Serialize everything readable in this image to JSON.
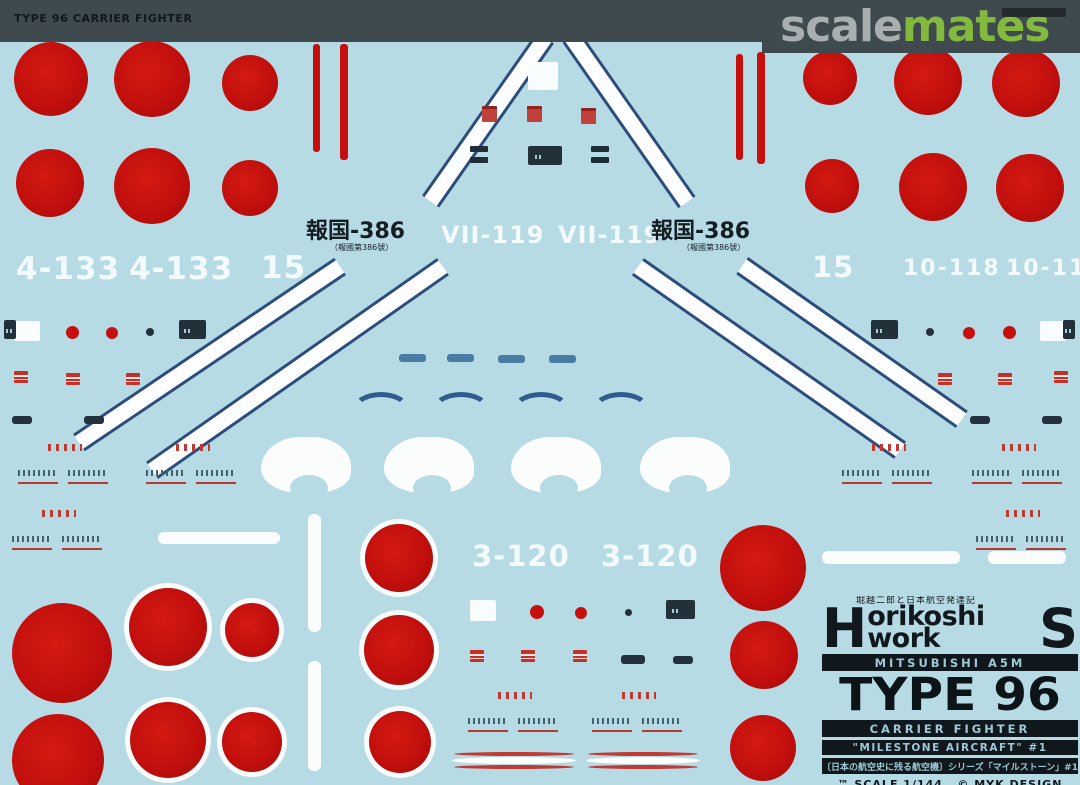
{
  "header": {
    "sheet_title": "TYPE 96 CARRIER FIGHTER",
    "logo_scale": "scale",
    "logo_mates": "mates"
  },
  "sheet": {
    "codes": {
      "tl_1": "4-133",
      "tl_2": "4-133",
      "tl_3": "15",
      "tc_1": "VII-119",
      "tc_2": "VII-119",
      "tr_1": "15",
      "tr_2": "10-118",
      "tr_3": "10-118",
      "bc_1": "3-120",
      "bc_2": "3-120",
      "hokoku_left": "報国-386",
      "hokoku_left_sub": "（報國第386號）",
      "hokoku_right": "報国-386",
      "hokoku_right_sub": "（報國第386號）"
    },
    "info_box": {
      "kanji_tagline": "堀越二郎と日本航空発達記",
      "brand_h": "H",
      "brand_mid": "orikoshi work",
      "brand_s": "S",
      "line1": "MITSUBISHI A5M",
      "line2": "TYPE 96",
      "line3": "CARRIER FIGHTER",
      "line4": "\"MILESTONE AIRCRAFT\" #1",
      "line5": "〔日本の航空史に残る航空機〕シリーズ「マイルストーン」#1",
      "line6": "™ SCALE 1/144   © MYK DESIGN"
    }
  },
  "colors": {
    "sheet_blue": "#b7dbe5",
    "hinomaru_red": "#c5100f",
    "stripe_navy": "#2c4d7c",
    "header_bar": "#3e4a4e",
    "logo_gray": "#a9aeb1",
    "logo_green": "#83b93d",
    "ink_black": "#10181d",
    "knockout_text": "#9fc8d4"
  },
  "decal_shapes": {
    "roundels": [
      {
        "cx": 51,
        "cy": 79,
        "r": 37
      },
      {
        "cx": 152,
        "cy": 79,
        "r": 38
      },
      {
        "cx": 250,
        "cy": 83,
        "r": 28
      },
      {
        "cx": 50,
        "cy": 183,
        "r": 34
      },
      {
        "cx": 152,
        "cy": 186,
        "r": 38
      },
      {
        "cx": 250,
        "cy": 188,
        "r": 28
      },
      {
        "cx": 830,
        "cy": 78,
        "r": 27
      },
      {
        "cx": 928,
        "cy": 81,
        "r": 34
      },
      {
        "cx": 1026,
        "cy": 83,
        "r": 34
      },
      {
        "cx": 832,
        "cy": 186,
        "r": 27
      },
      {
        "cx": 933,
        "cy": 187,
        "r": 34
      },
      {
        "cx": 1030,
        "cy": 188,
        "r": 34
      },
      {
        "cx": 62,
        "cy": 653,
        "r": 50
      },
      {
        "cx": 58,
        "cy": 760,
        "r": 46
      },
      {
        "cx": 168,
        "cy": 627,
        "r": 39,
        "ring": 1
      },
      {
        "cx": 252,
        "cy": 630,
        "r": 27,
        "ring": 1
      },
      {
        "cx": 168,
        "cy": 740,
        "r": 38,
        "ring": 1
      },
      {
        "cx": 252,
        "cy": 742,
        "r": 30,
        "ring": 1
      },
      {
        "cx": 399,
        "cy": 558,
        "r": 34,
        "ring": 1
      },
      {
        "cx": 399,
        "cy": 650,
        "r": 35,
        "ring": 1
      },
      {
        "cx": 400,
        "cy": 742,
        "r": 31,
        "ring": 1
      },
      {
        "cx": 763,
        "cy": 568,
        "r": 43
      },
      {
        "cx": 764,
        "cy": 655,
        "r": 34
      },
      {
        "cx": 763,
        "cy": 748,
        "r": 33
      }
    ],
    "bands": [
      {
        "cx": 488,
        "cy": 119,
        "len": 200,
        "ang": -55
      },
      {
        "cx": 629,
        "cy": 119,
        "len": 202,
        "ang": 55
      },
      {
        "cx": 209,
        "cy": 354,
        "len": 315,
        "ang": -34
      },
      {
        "cx": 297,
        "cy": 368,
        "len": 355,
        "ang": -35
      },
      {
        "cx": 769,
        "cy": 358,
        "len": 320,
        "ang": 35
      },
      {
        "cx": 852,
        "cy": 342,
        "len": 268,
        "ang": 35
      }
    ],
    "red_vbars": [
      {
        "x": 313,
        "y": 44,
        "w": 7,
        "h": 108
      },
      {
        "x": 340,
        "y": 44,
        "w": 8,
        "h": 116
      },
      {
        "x": 736,
        "y": 54,
        "w": 7,
        "h": 106
      },
      {
        "x": 757,
        "y": 52,
        "w": 8,
        "h": 112
      }
    ],
    "dashes": [
      {
        "x": 399,
        "y": 354
      },
      {
        "x": 447,
        "y": 354
      },
      {
        "x": 498,
        "y": 355
      },
      {
        "x": 549,
        "y": 355
      }
    ],
    "arcs": [
      {
        "x": 352,
        "y": 392
      },
      {
        "x": 432,
        "y": 392
      },
      {
        "x": 512,
        "y": 392
      },
      {
        "x": 592,
        "y": 392
      }
    ],
    "spats": [
      {
        "x": 261,
        "y": 437
      },
      {
        "x": 384,
        "y": 437
      },
      {
        "x": 511,
        "y": 437
      },
      {
        "x": 640,
        "y": 437
      }
    ],
    "white_bars": [
      {
        "x": 158,
        "y": 532,
        "w": 122,
        "h": 12
      },
      {
        "x": 308,
        "y": 514,
        "w": 13,
        "h": 118
      },
      {
        "x": 308,
        "y": 661,
        "w": 13,
        "h": 110
      },
      {
        "x": 822,
        "y": 551,
        "w": 138,
        "h": 13
      },
      {
        "x": 988,
        "y": 551,
        "w": 78,
        "h": 13
      }
    ],
    "curved_stripes": [
      {
        "x": 452,
        "y": 752,
        "w": 124
      },
      {
        "x": 586,
        "y": 752,
        "w": 114
      }
    ],
    "red_patches": [
      {
        "x": 14,
        "y": 371
      },
      {
        "x": 66,
        "y": 373
      },
      {
        "x": 126,
        "y": 373
      },
      {
        "x": 938,
        "y": 373
      },
      {
        "x": 998,
        "y": 373
      },
      {
        "x": 1054,
        "y": 371
      },
      {
        "x": 470,
        "y": 650
      },
      {
        "x": 521,
        "y": 650
      },
      {
        "x": 573,
        "y": 650
      }
    ],
    "red_squares": [
      {
        "x": 482,
        "y": 106
      },
      {
        "x": 527,
        "y": 106
      },
      {
        "x": 581,
        "y": 108
      }
    ],
    "dark_bars": [
      {
        "x": 12,
        "y": 416,
        "w": 20,
        "h": 8
      },
      {
        "x": 84,
        "y": 416,
        "w": 20,
        "h": 8
      },
      {
        "x": 970,
        "y": 416,
        "w": 20,
        "h": 8
      },
      {
        "x": 1042,
        "y": 416,
        "w": 20,
        "h": 8
      },
      {
        "x": 621,
        "y": 655,
        "w": 24,
        "h": 9
      },
      {
        "x": 673,
        "y": 656,
        "w": 20,
        "h": 8
      }
    ],
    "red_dots": [
      {
        "x": 66,
        "y": 326,
        "d": 13
      },
      {
        "x": 106,
        "y": 327,
        "d": 12
      },
      {
        "x": 963,
        "y": 327,
        "d": 12
      },
      {
        "x": 1003,
        "y": 326,
        "d": 13
      },
      {
        "x": 530,
        "y": 605,
        "d": 14
      },
      {
        "x": 575,
        "y": 607,
        "d": 12
      }
    ],
    "dark_dots": [
      {
        "x": 146,
        "y": 328,
        "d": 8
      },
      {
        "x": 926,
        "y": 328,
        "d": 8
      },
      {
        "x": 625,
        "y": 609,
        "d": 7
      }
    ],
    "white_blocks": [
      {
        "x": 14,
        "y": 321,
        "w": 26,
        "h": 20
      },
      {
        "x": 1040,
        "y": 321,
        "w": 26,
        "h": 20
      },
      {
        "x": 470,
        "y": 600,
        "w": 26,
        "h": 21
      },
      {
        "x": 528,
        "y": 62,
        "w": 30,
        "h": 28
      }
    ],
    "dark_blocks": [
      {
        "x": 179,
        "y": 320,
        "w": 27,
        "h": 19
      },
      {
        "x": 871,
        "y": 320,
        "w": 27,
        "h": 19
      },
      {
        "x": 666,
        "y": 600,
        "w": 29,
        "h": 19
      },
      {
        "x": 528,
        "y": 146,
        "w": 34,
        "h": 19
      },
      {
        "x": 4,
        "y": 320,
        "w": 12,
        "h": 19
      },
      {
        "x": 1063,
        "y": 320,
        "w": 12,
        "h": 19
      }
    ],
    "stencil_pairs": [
      {
        "x": 470,
        "y": 146
      },
      {
        "x": 591,
        "y": 146
      }
    ],
    "clusters": [
      {
        "x": 18,
        "y": 444
      },
      {
        "x": 146,
        "y": 444
      },
      {
        "x": 842,
        "y": 444
      },
      {
        "x": 972,
        "y": 444
      },
      {
        "x": 12,
        "y": 510
      },
      {
        "x": 976,
        "y": 510
      },
      {
        "x": 468,
        "y": 692
      },
      {
        "x": 592,
        "y": 692
      }
    ]
  }
}
